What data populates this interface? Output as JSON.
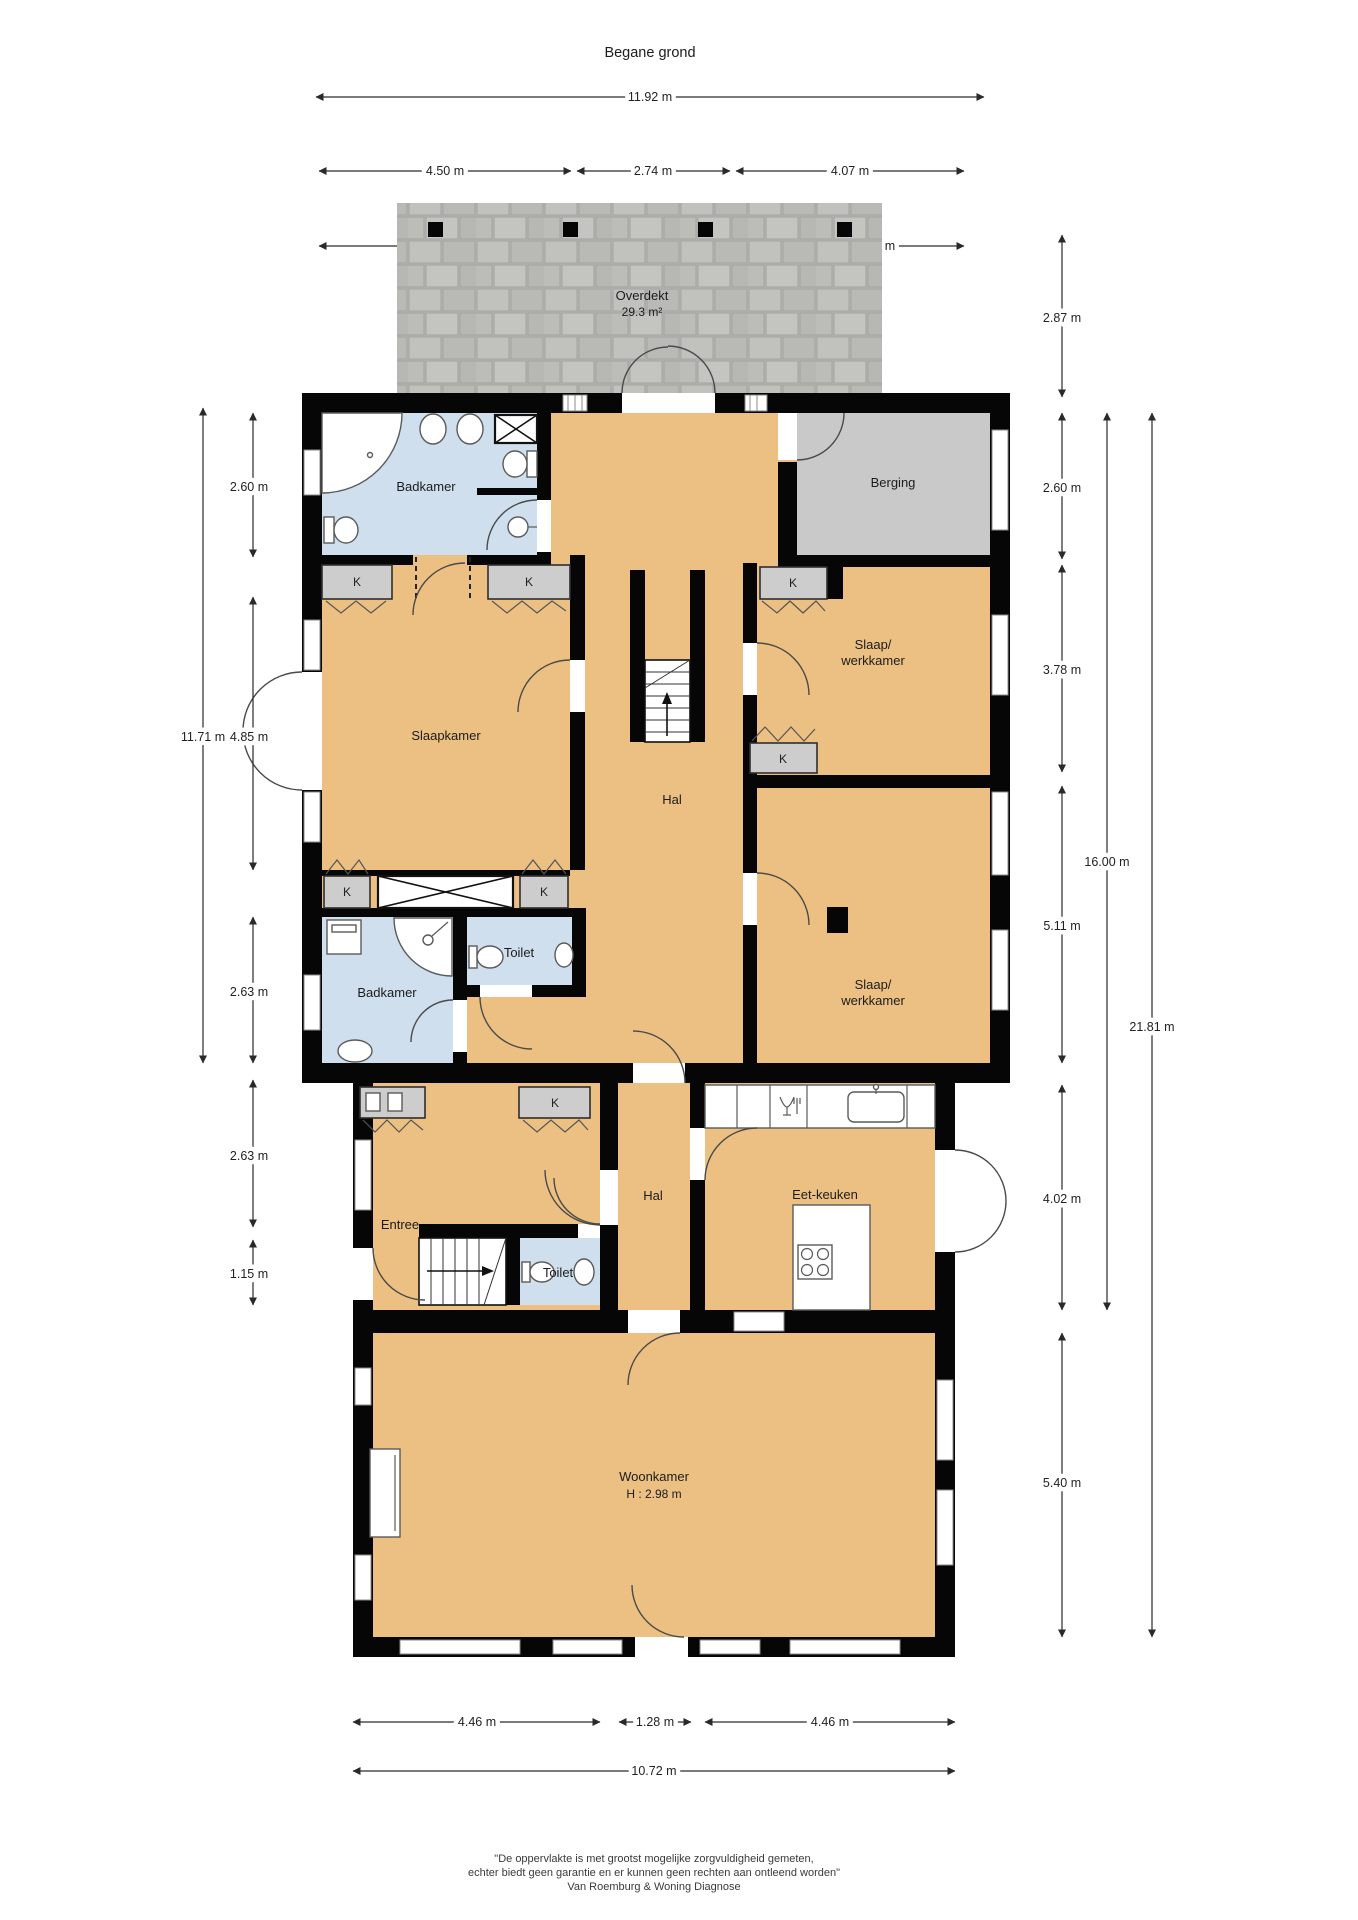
{
  "title": "Begane grond",
  "colors": {
    "floor": "#ecc083",
    "wet_room": "#cfdfee",
    "storage": "#c9c9c9",
    "wall": "#060606",
    "paving": "#b8b8b5"
  },
  "rooms": {
    "overdekt": {
      "label": "Overdekt",
      "area": "29.3 m²"
    },
    "badkamer": "Badkamer",
    "berging": "Berging",
    "slaapkamer": "Slaapkamer",
    "slaapwerk": {
      "line1": "Slaap/",
      "line2": "werkkamer"
    },
    "hal": "Hal",
    "toilet": "Toilet",
    "entree": "Entree",
    "eetkeuken": "Eet-keuken",
    "woonkamer": {
      "label": "Woonkamer",
      "ceiling": "H : 2.98 m"
    },
    "closet": "K"
  },
  "dims": {
    "top": {
      "total": "11.92 m",
      "row2": [
        "4.50 m",
        "2.74 m",
        "4.07 m"
      ],
      "row3": [
        "3.80 m",
        "4.38 m",
        "3.39 m"
      ]
    },
    "left": {
      "total": "11.71 m",
      "segments": [
        "2.60 m",
        "4.85 m",
        "2.63 m",
        "2.63 m",
        "1.15 m"
      ]
    },
    "right": {
      "segments": [
        "2.87 m",
        "2.60 m",
        "3.78 m",
        "5.11 m",
        "4.02 m",
        "5.40 m"
      ],
      "middle": "16.00 m",
      "total": "21.81 m"
    },
    "bottom": {
      "row1": [
        "4.46 m",
        "1.28 m",
        "4.46 m"
      ],
      "total": "10.72 m"
    }
  },
  "footer": {
    "line1": "\"De oppervlakte is met grootst mogelijke zorgvuldigheid gemeten,",
    "line2": "echter biedt geen garantie en er kunnen geen rechten aan ontleend worden\"",
    "line3": "Van Roemburg & Woning Diagnose"
  }
}
